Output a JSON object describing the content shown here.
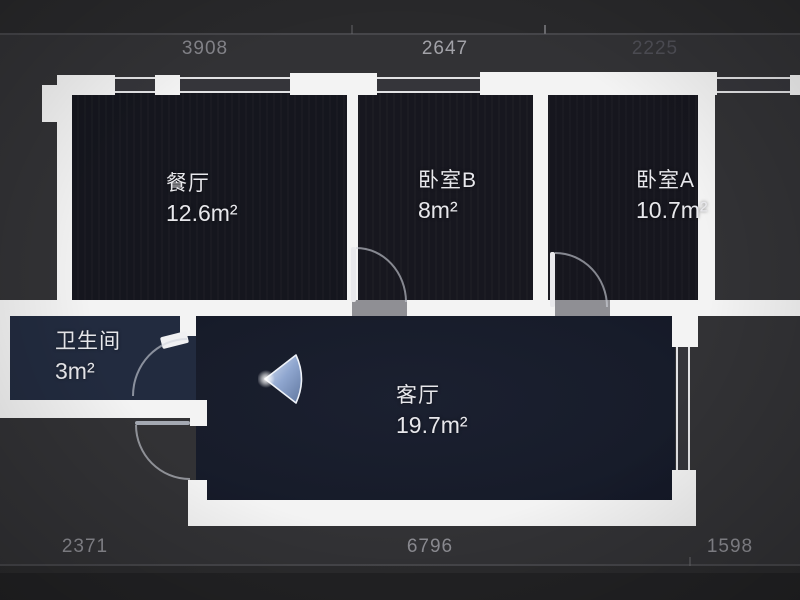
{
  "floorplan": {
    "rooms": [
      {
        "id": "dining",
        "name": "餐厅",
        "area": "12.6m²"
      },
      {
        "id": "bedroom-b",
        "name": "卧室B",
        "area": "8m²"
      },
      {
        "id": "bedroom-a",
        "name": "卧室A",
        "area": "10.7m²"
      },
      {
        "id": "bathroom",
        "name": "卫生间",
        "area": "3m²"
      },
      {
        "id": "living",
        "name": "客厅",
        "area": "19.7m²"
      }
    ],
    "dimensions": {
      "top": [
        "3908",
        "2647",
        "2225"
      ],
      "bottom": [
        "2371",
        "6796",
        "1598"
      ]
    },
    "icons": {
      "viewpoint": "panorama-viewpoint"
    },
    "colors": {
      "wall": "#f3f3f3",
      "dining": "#15161e",
      "bedroom": "#17171f",
      "bathroom": "#222b3f",
      "living": "#181d2b",
      "background": "#323235",
      "viewpoint_accent": "#9db4dd",
      "dimension_text": "#84848a"
    }
  }
}
